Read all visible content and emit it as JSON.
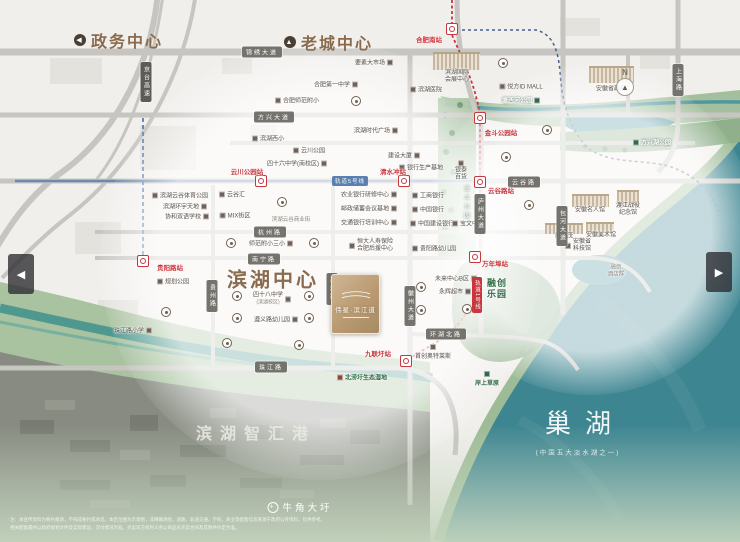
{
  "titles": {
    "gov": "政务中心",
    "old_town": "老城中心",
    "binhu_center": "滨湖中心",
    "zhihui_port": "滨湖智汇港",
    "lake": "巢湖",
    "lake_sub": "(中国五大淡水湖之一)",
    "niujiao": "牛角大圩",
    "compass": "N",
    "gov_arrow": "◀",
    "old_arrow": "▲"
  },
  "project": {
    "name": "伟星·滨江道"
  },
  "nav": {
    "prev": "◀",
    "next": "▶"
  },
  "transit": {
    "line5_label": "轨道5号线",
    "line5_x": 350,
    "line5_y": 181,
    "line5_color": "#5b7fae",
    "line1_label": "轨道1号线",
    "line1_x": 477,
    "line1_y": 295,
    "line1_color": "#c9363d"
  },
  "stations": [
    {
      "name": "station-hefeinan",
      "label": "合肥南站",
      "ix": 452,
      "iy": 29,
      "lx": 429,
      "ly": 39
    },
    {
      "name": "station-yunchuanpark",
      "label": "云川公园站",
      "ix": 261,
      "iy": 181,
      "lx": 247,
      "ly": 171
    },
    {
      "name": "station-qingshuichong",
      "label": "清水冲站",
      "ix": 404,
      "iy": 181,
      "lx": 393,
      "ly": 171
    },
    {
      "name": "station-guiyanglu",
      "label": "贵阳路站",
      "ix": 143,
      "iy": 261,
      "lx": 170,
      "ly": 267
    },
    {
      "name": "station-jindoupark",
      "label": "金斗公园站",
      "ix": 480,
      "iy": 118,
      "lx": 501,
      "ly": 132
    },
    {
      "name": "station-yungulu",
      "label": "云谷路站",
      "ix": 480,
      "iy": 182,
      "lx": 501,
      "ly": 190
    },
    {
      "name": "station-wannianbu",
      "label": "万年埠站",
      "ix": 475,
      "iy": 257,
      "lx": 495,
      "ly": 263
    },
    {
      "name": "station-jiulianwei",
      "label": "九联圩站",
      "ix": 406,
      "iy": 361,
      "lx": 378,
      "ly": 353
    }
  ],
  "roads_h": [
    {
      "label": "锦绣大道",
      "x": 262,
      "y": 52
    },
    {
      "label": "方兴大道",
      "x": 274,
      "y": 117
    },
    {
      "label": "云谷路",
      "x": 524,
      "y": 182
    },
    {
      "label": "杭州路",
      "x": 270,
      "y": 232
    },
    {
      "label": "南宁路",
      "x": 264,
      "y": 259
    },
    {
      "label": "珠江路",
      "x": 271,
      "y": 367
    },
    {
      "label": "环湖北路",
      "x": 446,
      "y": 334
    }
  ],
  "roads_v": [
    {
      "label": "贵州路",
      "x": 212,
      "y": 296
    },
    {
      "label": "西藏路",
      "x": 332,
      "y": 289
    },
    {
      "label": "徽州大道",
      "x": 410,
      "y": 306
    },
    {
      "label": "庐州大道",
      "x": 480,
      "y": 214
    },
    {
      "label": "包河大道",
      "x": 562,
      "y": 226
    },
    {
      "label": "上海路",
      "x": 678,
      "y": 80
    },
    {
      "label": "京台高速",
      "x": 146,
      "y": 82,
      "hw": true
    }
  ],
  "parks": [
    {
      "label": "塘西河公园",
      "x": 521,
      "y": 100,
      "kind": "ongreen",
      "icon": "r"
    },
    {
      "label": "方兴湖公园",
      "x": 652,
      "y": 142,
      "kind": "ongreen",
      "icon": "l"
    },
    {
      "label": "金斗公园",
      "x": 466,
      "y": 203,
      "kind": "vgreen"
    },
    {
      "label": "北涝圩生态湿地",
      "x": 362,
      "y": 377,
      "kind": "green",
      "icon": "l"
    },
    {
      "label": "岸上草原",
      "x": 487,
      "y": 379,
      "kind": "green",
      "icon": "t"
    },
    {
      "label": "融创乐园",
      "x": 497,
      "y": 289,
      "kind": "greenbig",
      "lines": [
        "融创",
        "乐园"
      ]
    }
  ],
  "pois": [
    {
      "l": "要素大市场",
      "x": 374,
      "y": 62,
      "ic": "r"
    },
    {
      "l": "合肥第一中学",
      "x": 336,
      "y": 84,
      "ic": "r"
    },
    {
      "l": "合肥师范附小",
      "x": 297,
      "y": 100,
      "ic": "l"
    },
    {
      "l": "滨湖医院",
      "x": 426,
      "y": 89,
      "ic": "l"
    },
    {
      "l": "悦方ID MALL",
      "x": 521,
      "y": 86,
      "ic": "l"
    },
    {
      "l": "安徽省政府",
      "x": 611,
      "y": 88,
      "sk": {
        "x": 589,
        "y": 66,
        "w": 45,
        "h": 15
      }
    },
    {
      "l": "滨湖国际会展中心",
      "x": 457,
      "y": 77,
      "lines": [
        "滨湖国际",
        "会展中心"
      ],
      "sk": {
        "x": 433,
        "y": 52,
        "w": 47,
        "h": 16
      }
    },
    {
      "l": "滨湖时代广场",
      "x": 376,
      "y": 130,
      "ic": "r"
    },
    {
      "l": "云川公园",
      "x": 309,
      "y": 150,
      "ic": "l"
    },
    {
      "l": "四十六中学(南校区)",
      "x": 297,
      "y": 163,
      "ic": "r"
    },
    {
      "l": "滨湖西小",
      "x": 268,
      "y": 138,
      "ic": "l"
    },
    {
      "l": "建设大厦",
      "x": 404,
      "y": 155,
      "ic": "r"
    },
    {
      "l": "银行生产基地",
      "x": 421,
      "y": 167,
      "ic": "l"
    },
    {
      "l": "云谷汇",
      "x": 232,
      "y": 194,
      "ic": "l"
    },
    {
      "l": "滨湖云谷体育公园",
      "x": 180,
      "y": 195,
      "ic": "l"
    },
    {
      "l": "滨湖环宇天地",
      "x": 185,
      "y": 206,
      "ic": "r"
    },
    {
      "l": "协和双语学校",
      "x": 187,
      "y": 216,
      "ic": "r"
    },
    {
      "l": "MIX街区",
      "x": 235,
      "y": 215,
      "ic": "l"
    },
    {
      "l": "滨湖云谷商业街",
      "x": 291,
      "y": 219,
      "plain": true
    },
    {
      "l": "师范附小三小",
      "x": 271,
      "y": 243,
      "ic": "r"
    },
    {
      "l": "农业银行研修中心",
      "x": 369,
      "y": 194,
      "ic": "r"
    },
    {
      "l": "邮政储蓄会议基地",
      "x": 369,
      "y": 208,
      "ic": "r"
    },
    {
      "l": "交通银行培训中心",
      "x": 369,
      "y": 222,
      "ic": "r"
    },
    {
      "l": "工商银行",
      "x": 428,
      "y": 195,
      "ic": "l"
    },
    {
      "l": "中国银行",
      "x": 428,
      "y": 209,
      "ic": "l"
    },
    {
      "l": "中国建设银行",
      "x": 432,
      "y": 223,
      "ic": "l"
    },
    {
      "l": "宝文中心",
      "x": 468,
      "y": 223,
      "ic": "l"
    },
    {
      "l": "贵阳路幼儿园",
      "x": 434,
      "y": 248,
      "ic": "l"
    },
    {
      "l": "恒大人寿保险合肥后援中心",
      "x": 371,
      "y": 246,
      "lines": [
        "恒大人寿保险",
        "合肥后援中心"
      ],
      "ic": "l"
    },
    {
      "l": "银泰百货",
      "x": 461,
      "y": 171,
      "lines": [
        "银泰",
        "百货"
      ],
      "ic": "t"
    },
    {
      "l": "规划公园",
      "x": 173,
      "y": 281,
      "ic": "l"
    },
    {
      "l": "四十八中学",
      "x": 272,
      "y": 299,
      "ic": "r",
      "sub": "(滨湖校区)"
    },
    {
      "l": "遵义路幼儿园",
      "x": 276,
      "y": 319,
      "ic": "r"
    },
    {
      "l": "珠江路小学",
      "x": 133,
      "y": 330,
      "ic": "r"
    },
    {
      "l": "未来中心B区",
      "x": 456,
      "y": 278,
      "ic": "r"
    },
    {
      "l": "永辉超市",
      "x": 455,
      "y": 291,
      "ic": "r"
    },
    {
      "l": "首创奥特莱斯",
      "x": 433,
      "y": 352,
      "ic": "t"
    },
    {
      "l": "融创茂",
      "x": 564,
      "y": 235,
      "sk": {
        "x": 545,
        "y": 223,
        "w": 38,
        "h": 9
      }
    },
    {
      "l": "安徽名人馆",
      "x": 590,
      "y": 209,
      "sk": {
        "x": 572,
        "y": 194,
        "w": 37,
        "h": 11
      }
    },
    {
      "l": "渡江战役纪念馆",
      "x": 628,
      "y": 210,
      "lines": [
        "渡江战役",
        "纪念馆"
      ],
      "sk": {
        "x": 617,
        "y": 190,
        "w": 22,
        "h": 14
      }
    },
    {
      "l": "安徽美术馆",
      "x": 601,
      "y": 234,
      "sk": {
        "x": 586,
        "y": 222,
        "w": 28,
        "h": 9
      }
    },
    {
      "l": "安徽省科技馆",
      "x": 578,
      "y": 246,
      "lines": [
        "安徽省",
        "科技馆"
      ],
      "ic": "l"
    },
    {
      "l": "融创酒店群",
      "x": 616,
      "y": 271,
      "lines": [
        "融创",
        "酒店群"
      ],
      "plain": true
    }
  ],
  "community_markers": [
    [
      356,
      101
    ],
    [
      503,
      63
    ],
    [
      506,
      157
    ],
    [
      282,
      202
    ],
    [
      231,
      243
    ],
    [
      314,
      243
    ],
    [
      166,
      312
    ],
    [
      237,
      296
    ],
    [
      309,
      296
    ],
    [
      237,
      318
    ],
    [
      309,
      318
    ],
    [
      227,
      343
    ],
    [
      299,
      345
    ],
    [
      421,
      287
    ],
    [
      421,
      310
    ],
    [
      467,
      309
    ],
    [
      529,
      205
    ],
    [
      547,
      130
    ]
  ],
  "disclaimer": {
    "line1": "注：本宣传资料为要约邀请，不构成要约或承诺。本区位图为示意图，非精确测绘，道路、轨道交通、学校、商业等配套信息来源于政府公开资料，仅供参考。",
    "line2": "相关配套最终以政府规划文件及实际建设、交付情况为准。买卖双方权利义务以商品房买卖合同及其附件约定为准。"
  },
  "colors": {
    "metro_red": "#c9363d",
    "metro_blue": "#5b7fae",
    "brand_brown": "#8a6b4e",
    "lake_teal": "#3d8591",
    "park_green": "#a3bf9d",
    "project_gold": "#b99a72"
  }
}
